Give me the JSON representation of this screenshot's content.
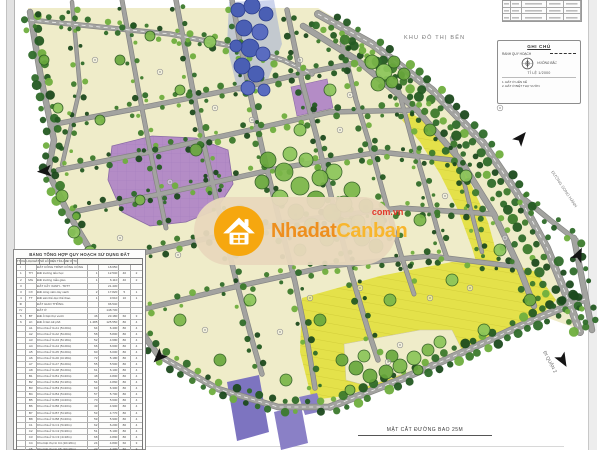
{
  "map": {
    "area_label": "KHU ĐÔ THỊ BẾN",
    "label_right": "ĐƯỜNG SONG HÀNH",
    "label_bottom": "ĐI QUẬN 2",
    "caption": "MẶT CẮT ĐƯỜNG BAO 25M"
  },
  "watermark": {
    "brand_left": "Nhadat",
    "brand_right": "Canban",
    "domain": "com.vn"
  },
  "legend": {
    "title": "GHI CHÚ",
    "row1_label": "RANH QUY HOẠCH",
    "row2_label": "HƯỚNG BẮC",
    "scale_label": "TỈ LỆ",
    "scale_value": "1/2000",
    "notes": [
      "1. ĐẤT Ở LIÊN KẾ",
      "2. ĐẤT Ở BIỆT THỰ VƯỜN"
    ]
  },
  "land_table": {
    "title": "BẢNG TỔNG HỢP QUY HOẠCH SỬ DỤNG ĐẤT",
    "headers": [
      "TT",
      "KH",
      "LOẠI ĐẤT",
      "SỐ LÔ",
      "DIỆN TÍCH",
      "MĐ %",
      "TC"
    ],
    "rows": [
      [
        "I",
        "",
        "ĐẤT CÔNG TRÌNH CÔNG CỘNG",
        "",
        "18.650",
        "",
        ""
      ],
      [
        "1",
        "TH",
        "Đất trường tiểu học",
        "1",
        "12.540",
        "40",
        "2"
      ],
      [
        "2",
        "MG",
        "Đất trường mẫu giáo",
        "1",
        "6.110",
        "40",
        "2"
      ],
      [
        "II",
        "",
        "ĐẤT CÂY XANH - TDTT",
        "",
        "21.430",
        "",
        ""
      ],
      [
        "3",
        "CX",
        "Đất công viên cây xanh",
        "2",
        "17.820",
        "5",
        "1"
      ],
      [
        "4",
        "TT",
        "Đất sân thể dục thể thao",
        "1",
        "3.610",
        "10",
        "1"
      ],
      [
        "III",
        "",
        "ĐẤT GIAO THÔNG",
        "",
        "96.540",
        "",
        ""
      ],
      [
        "IV",
        "",
        "ĐẤT Ở",
        "",
        "148.730",
        "",
        ""
      ],
      [
        "5",
        "BT",
        "Đất ở biệt thự vườn",
        "46",
        "23.180",
        "60",
        "3"
      ],
      [
        "6",
        "LK",
        "Đất ở liên kế phố",
        "1.485",
        "125.550",
        "80",
        "4"
      ],
      [
        "",
        "A1",
        "Khu nhà ở lô A1 (5×20m)",
        "64",
        "6.400",
        "80",
        "4"
      ],
      [
        "",
        "A2",
        "Khu nhà ở lô A2 (5×20m)",
        "58",
        "5.800",
        "80",
        "4"
      ],
      [
        "",
        "A3",
        "Khu nhà ở lô A3 (5×18m)",
        "52",
        "4.680",
        "80",
        "4"
      ],
      [
        "",
        "A4",
        "Khu nhà ở lô A4 (5×20m)",
        "66",
        "6.600",
        "80",
        "4"
      ],
      [
        "",
        "A5",
        "Khu nhà ở lô A5 (5×20m)",
        "60",
        "6.000",
        "80",
        "4"
      ],
      [
        "",
        "A6",
        "Khu nhà ở lô A6 (4×18m)",
        "72",
        "5.180",
        "80",
        "4"
      ],
      [
        "",
        "A7",
        "Khu nhà ở lô A7 (5×20m)",
        "55",
        "5.500",
        "80",
        "4"
      ],
      [
        "",
        "A8",
        "Khu nhà ở lô A8 (5×20m)",
        "61",
        "6.100",
        "80",
        "4"
      ],
      [
        "",
        "B1",
        "Khu nhà ở lô B1 (5×20m)",
        "48",
        "4.800",
        "80",
        "4"
      ],
      [
        "",
        "B2",
        "Khu nhà ở lô B2 (5×18m)",
        "54",
        "4.860",
        "80",
        "4"
      ],
      [
        "",
        "B3",
        "Khu nhà ở lô B3 (5×20m)",
        "63",
        "6.300",
        "80",
        "4"
      ],
      [
        "",
        "B4",
        "Khu nhà ở lô B4 (5×20m)",
        "57",
        "5.700",
        "80",
        "4"
      ],
      [
        "",
        "B5",
        "Khu nhà ở lô B5 (4×20m)",
        "70",
        "5.600",
        "80",
        "4"
      ],
      [
        "",
        "B6",
        "Khu nhà ở lô B6 (5×20m)",
        "49",
        "4.900",
        "80",
        "4"
      ],
      [
        "",
        "B7",
        "Khu nhà ở lô B7 (5×18m)",
        "53",
        "4.770",
        "80",
        "4"
      ],
      [
        "",
        "B8",
        "Khu nhà ở lô B8 (5×20m)",
        "59",
        "5.900",
        "80",
        "4"
      ],
      [
        "",
        "C1",
        "Khu nhà ở lô C1 (5×20m)",
        "62",
        "6.200",
        "80",
        "4"
      ],
      [
        "",
        "C2",
        "Khu nhà ở lô C2 (5×20m)",
        "51",
        "5.100",
        "80",
        "4"
      ],
      [
        "",
        "C3",
        "Khu nhà ở lô C3 (4×18m)",
        "68",
        "4.890",
        "80",
        "4"
      ],
      [
        "",
        "C4",
        "Khu biệt thự lô C4 (10×20m)",
        "24",
        "4.800",
        "60",
        "3"
      ],
      [
        "",
        "C5",
        "Khu biệt thự lô C5 (10×20m)",
        "22",
        "4.400",
        "60",
        "3"
      ],
      [
        "",
        "D1",
        "Khu nhà ở lô D1 (5×20m)",
        "56",
        "5.600",
        "80",
        "4"
      ],
      [
        "",
        "D2",
        "Khu nhà ở lô D2 (5×20m)",
        "60",
        "6.000",
        "80",
        "4"
      ],
      [
        "",
        "D3",
        "Khu nhà ở lô D3 (5×18m)",
        "47",
        "4.230",
        "80",
        "4"
      ]
    ]
  },
  "colors": {
    "lot_cream": "#efecc9",
    "road_gray": "#a3a3a0",
    "public_purple": "#b48cc6",
    "mixed_yellow": "#e4e14a",
    "special_blue": "#4a5fb4",
    "park_green": "#7ab648",
    "watermark_orange": "#f6a70f"
  }
}
